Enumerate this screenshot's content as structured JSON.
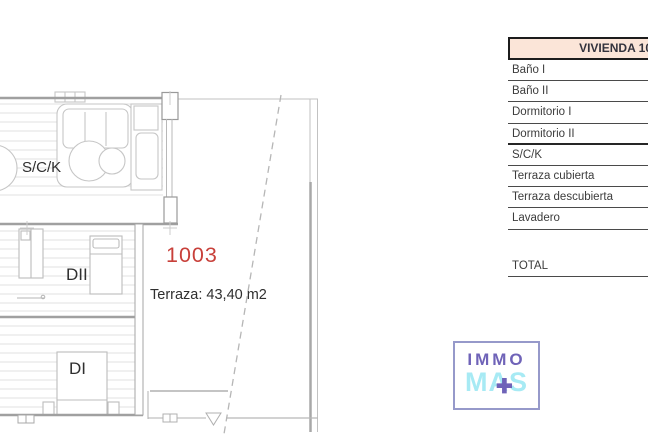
{
  "plan": {
    "labels": {
      "living_kitchen": "S/C/K",
      "dormitorio_2": "DII",
      "dormitorio_1": "DI",
      "unit_number": "1003",
      "terrace_area": "Terraza: 43,40 m2"
    },
    "colors": {
      "unit_number": "#c8403a",
      "walls": "#a0a0a0",
      "furniture": "#c4c4c4"
    }
  },
  "table": {
    "header": {
      "label": "VIVIENDA 10",
      "background": "#fbe5d8"
    },
    "rows": [
      "Baño I",
      "Baño II",
      "Dormitorio I",
      "Dormitorio II",
      "S/C/K",
      "Terraza cubierta",
      "Terraza descubierta",
      "Lavadero"
    ],
    "total_label": "TOTAL"
  },
  "logo": {
    "line1": "IMMO",
    "line2": "MAS",
    "plus_icon": "✚",
    "colors": {
      "purple": "#6f63b8",
      "cyan": "#a7eaf4",
      "border": "#9699ca"
    }
  }
}
